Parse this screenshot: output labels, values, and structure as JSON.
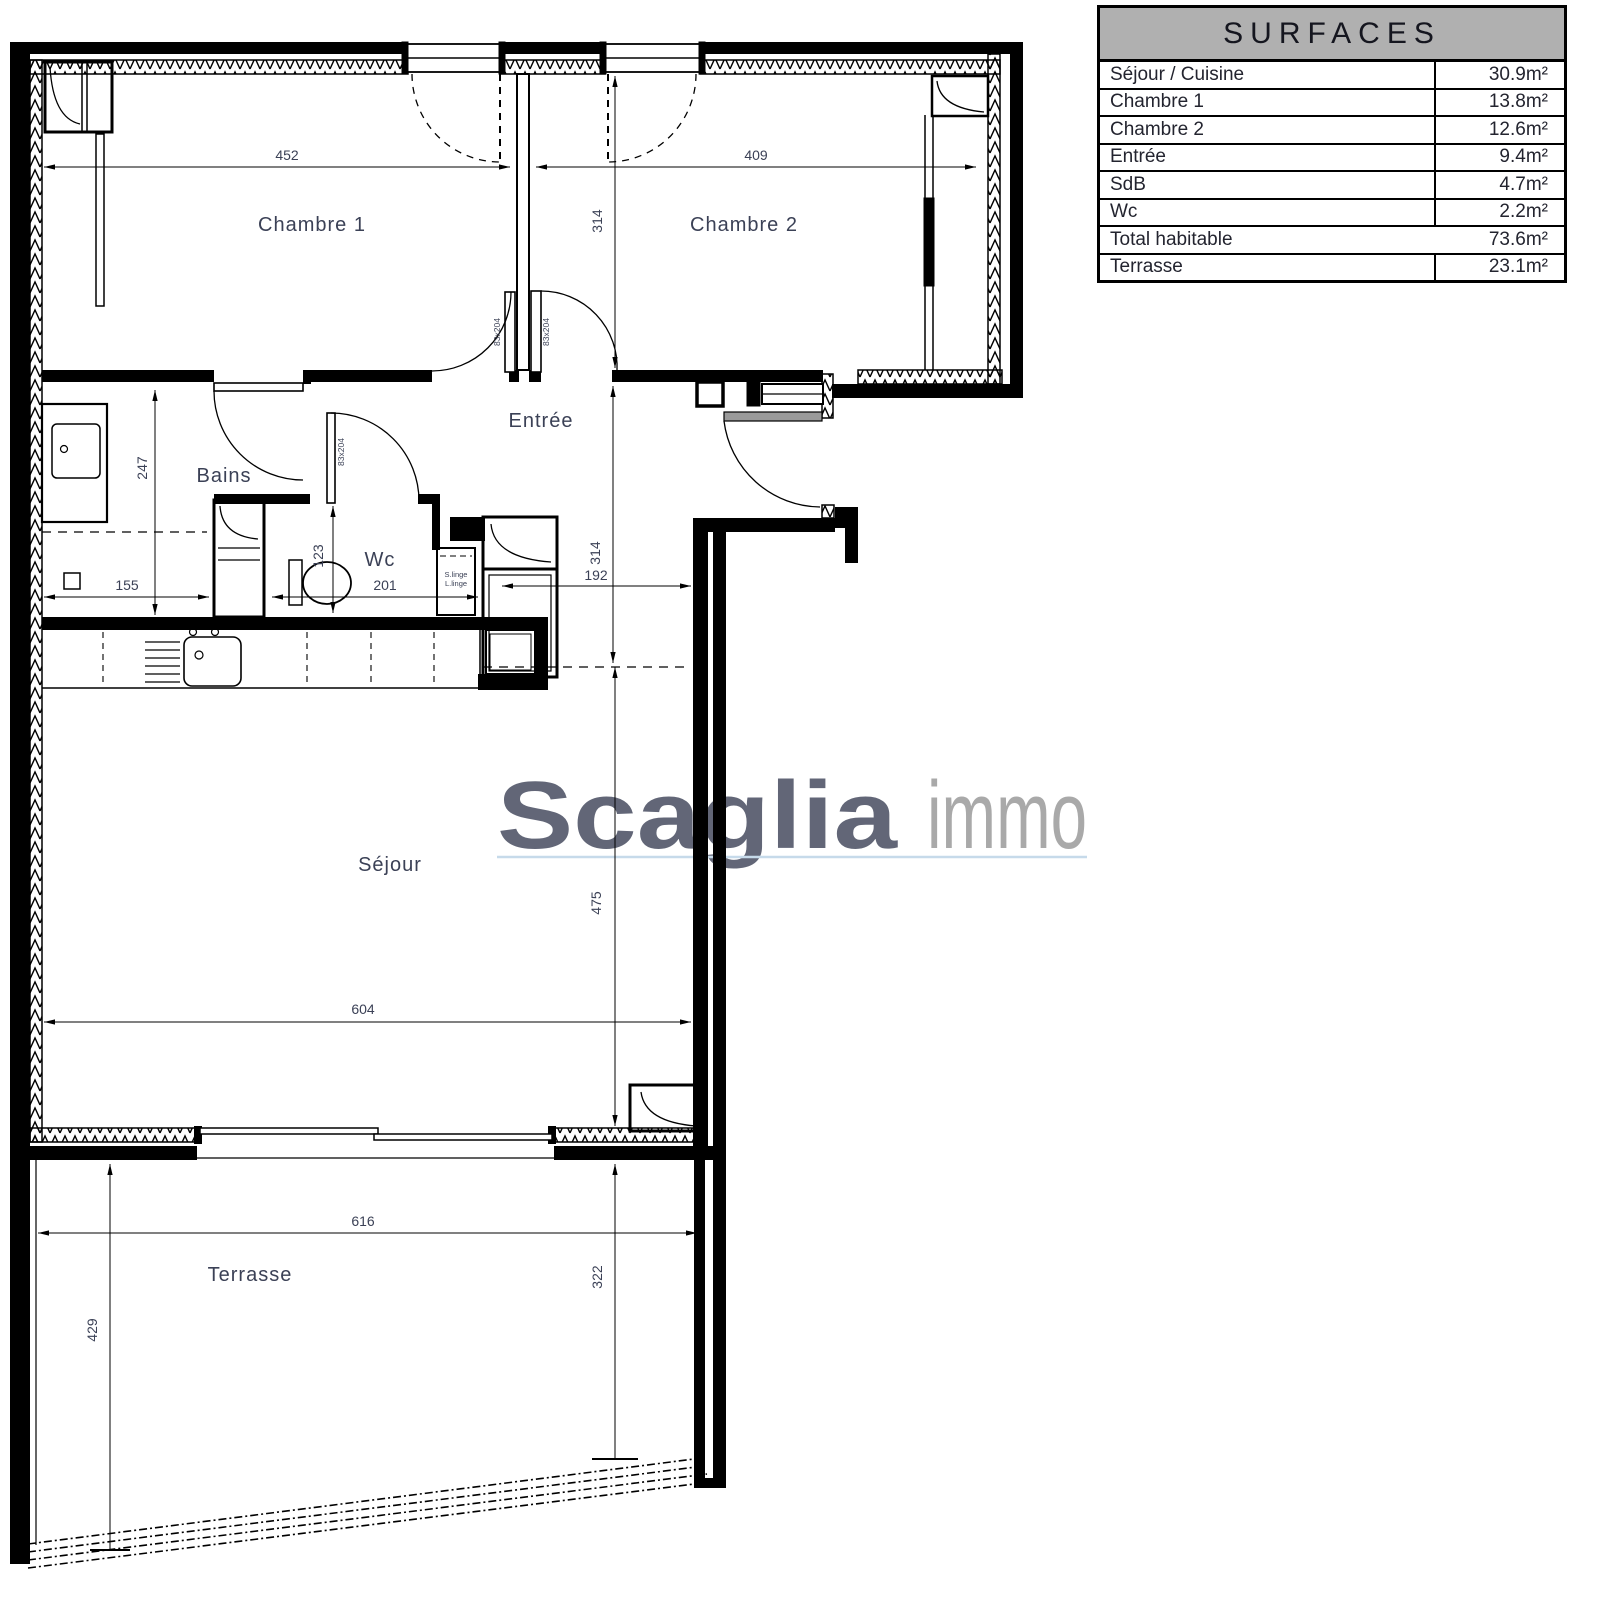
{
  "table": {
    "title": "SURFACES",
    "rows": [
      {
        "label": "Séjour / Cuisine",
        "value": "30.9m²"
      },
      {
        "label": "Chambre 1",
        "value": "13.8m²"
      },
      {
        "label": "Chambre 2",
        "value": "12.6m²"
      },
      {
        "label": "Entrée",
        "value": "9.4m²"
      },
      {
        "label": "SdB",
        "value": "4.7m²"
      },
      {
        "label": "Wc",
        "value": "2.2m²"
      },
      {
        "label": "Total habitable",
        "value": "73.6m²"
      },
      {
        "label": "Terrasse",
        "value": "23.1m²"
      }
    ]
  },
  "logo": {
    "brand_bold": "Scaglia",
    "brand_light": "immo"
  },
  "rooms": {
    "chambre1": "Chambre 1",
    "chambre2": "Chambre 2",
    "entree": "Entrée",
    "bains": "Bains",
    "wc": "Wc",
    "sejour": "Séjour",
    "terrasse": "Terrasse",
    "linge_line1": "S.linge",
    "linge_line2": "L.linge"
  },
  "dims": {
    "d452": "452",
    "d409": "409",
    "d314_ch2": "314",
    "d314_entree": "314",
    "d192": "192",
    "d247": "247",
    "d155": "155",
    "d123": "123",
    "d201": "201",
    "d475": "475",
    "d604": "604",
    "d616": "616",
    "d322": "322",
    "d429": "429",
    "door_labels": [
      "83x204",
      "83x204",
      "83x204"
    ]
  },
  "colors": {
    "wall": "#000000",
    "label_text": "#3b4156",
    "table_header_bg": "#b0b0b0",
    "logo_gray": "#8a8a8a",
    "logo_underline": "#b9d2e5"
  }
}
